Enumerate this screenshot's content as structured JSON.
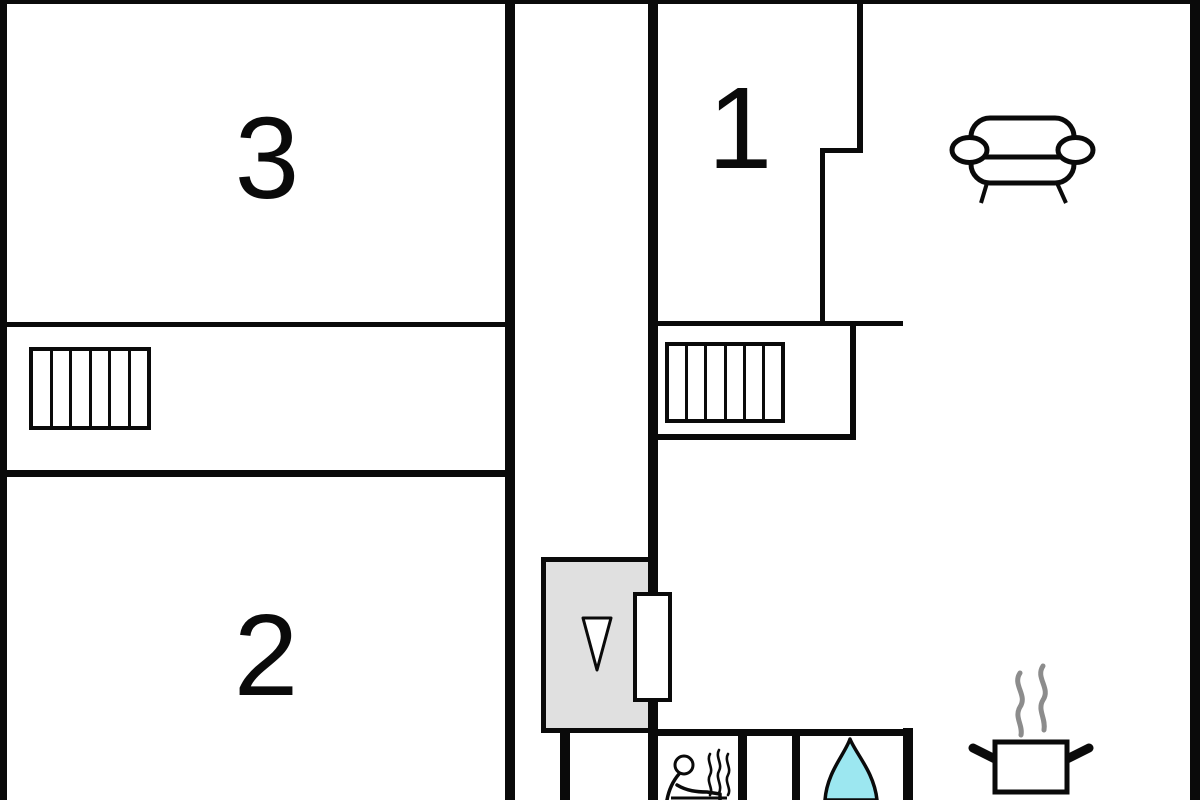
{
  "plan": {
    "type": "apartment-floor-plan",
    "rooms": [
      {
        "id": "room-3",
        "label": "3"
      },
      {
        "id": "room-1",
        "label": "1"
      },
      {
        "id": "room-2",
        "label": "2"
      }
    ],
    "icons": [
      "sofa-icon",
      "stairs-upper-left-icon",
      "stairs-upper-right-icon",
      "elevator-down-arrow-icon",
      "door-icon",
      "sauna-person-icon",
      "steam-icon",
      "flame-icon",
      "cooking-pot-icon"
    ],
    "colors": {
      "wall": "#0a0a0a",
      "background": "#ffffff",
      "elevator_fill": "#e0e0e0",
      "flame_fill": "#9ce7f0",
      "steam_gray": "#8c8c8c"
    }
  }
}
